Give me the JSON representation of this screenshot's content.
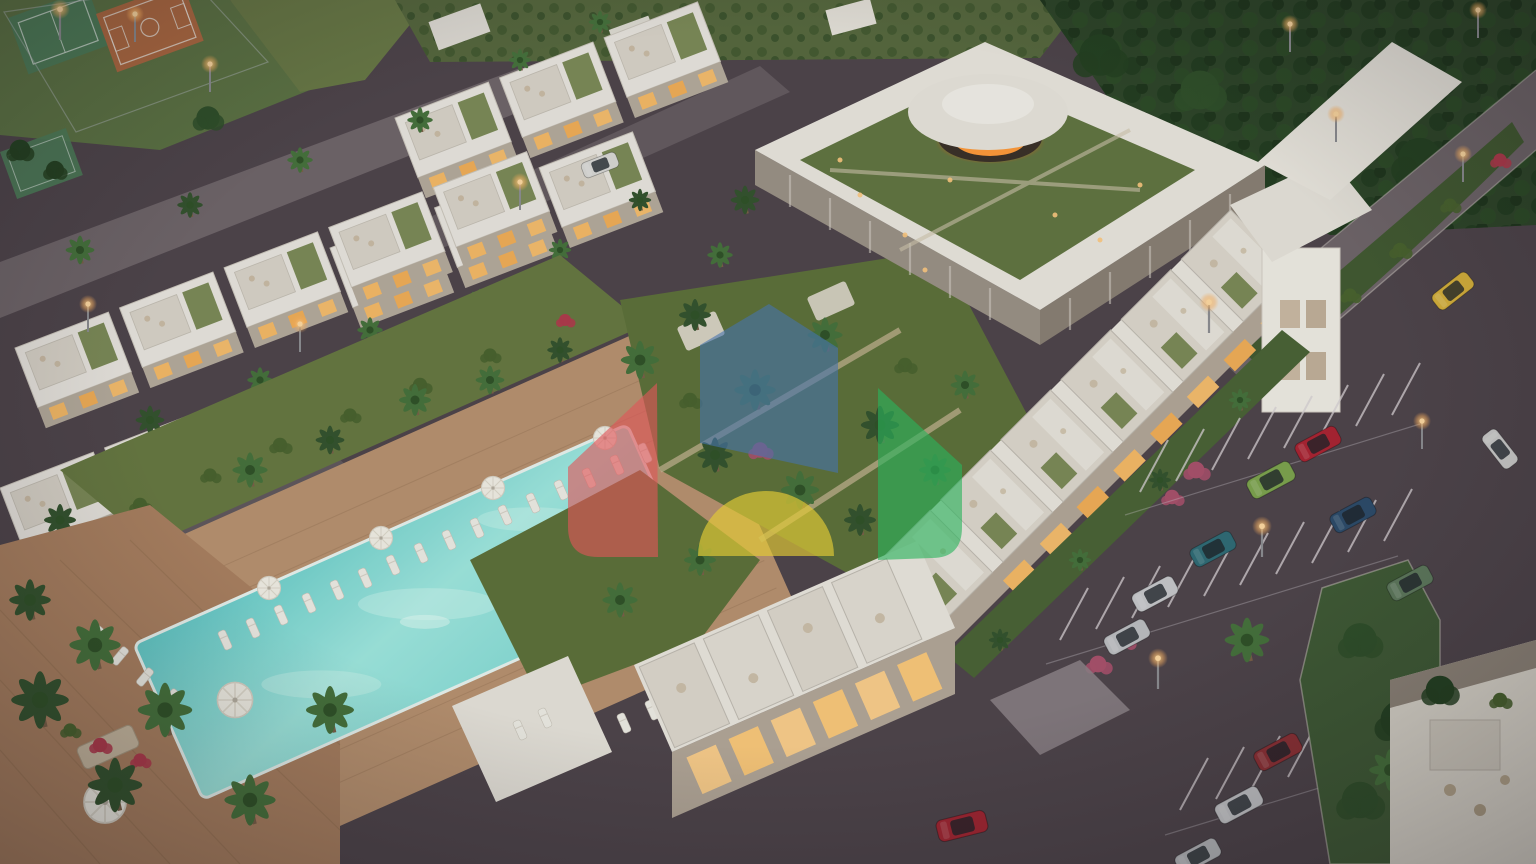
{
  "scene": {
    "type": "aerial-architectural-render",
    "setting": "resort residential complex at dusk with pool, villas, clubhouse and parking"
  },
  "palette": {
    "asphalt": "#4e4349",
    "road": "#6f6468",
    "internal_road": "#645a5e",
    "pool_deck": "#b8916e",
    "wood_deck": "#a97f5e",
    "grass": "#66773f",
    "garden": "#5d7038",
    "lawn": "#5d7342",
    "field": "#6a7a45",
    "forest": "#2d4527",
    "orchard": "#57683c",
    "building_white": "#eae6dc",
    "building_face": "#b3a696",
    "facade_slats": "#8a7f72",
    "facade_slats_light": "#9b9184",
    "window_warm": "#f6b964",
    "window_bright": "#ffd089",
    "court_green": "#4e7d57",
    "court_orange": "#b06a40",
    "dome_glow": "#ff9a38",
    "parking_line": "#d9d2d4",
    "curb": "#d0c9c1",
    "plaza": "#8d8286",
    "island_green": "#3f5a33",
    "strip_green": "#4a6234"
  },
  "watermark": {
    "opacity": 0.62,
    "houses": [
      {
        "name": "red-house-left",
        "color": "#e05558"
      },
      {
        "name": "blue-house-center",
        "color": "#4673ae"
      },
      {
        "name": "yellow-house-bottom",
        "color": "#e3cc35"
      },
      {
        "name": "green-house-right",
        "color": "#2ab35c"
      }
    ]
  },
  "vehicles": [
    {
      "type": "sports-car",
      "color": "#ab2330"
    },
    {
      "type": "suv-jeep",
      "color": "#7da34c"
    },
    {
      "type": "hatchback",
      "color": "#2f6b74"
    },
    {
      "type": "sedan",
      "color": "#2c4a68"
    },
    {
      "type": "suv",
      "color": "#c7c7c9"
    },
    {
      "type": "suv",
      "color": "#bdbec0"
    },
    {
      "type": "suv",
      "color": "#5f7a5c"
    },
    {
      "type": "suv",
      "color": "#8e2f33"
    },
    {
      "type": "suv",
      "color": "#c6c6c8"
    },
    {
      "type": "sedan",
      "color": "#b8b9bb"
    },
    {
      "type": "coupe",
      "color": "#d9b23a"
    },
    {
      "type": "convertible",
      "color": "#a32530"
    },
    {
      "type": "hatchback",
      "color": "#d9d8d4"
    },
    {
      "type": "sedan",
      "color": "#cfcecb"
    }
  ]
}
